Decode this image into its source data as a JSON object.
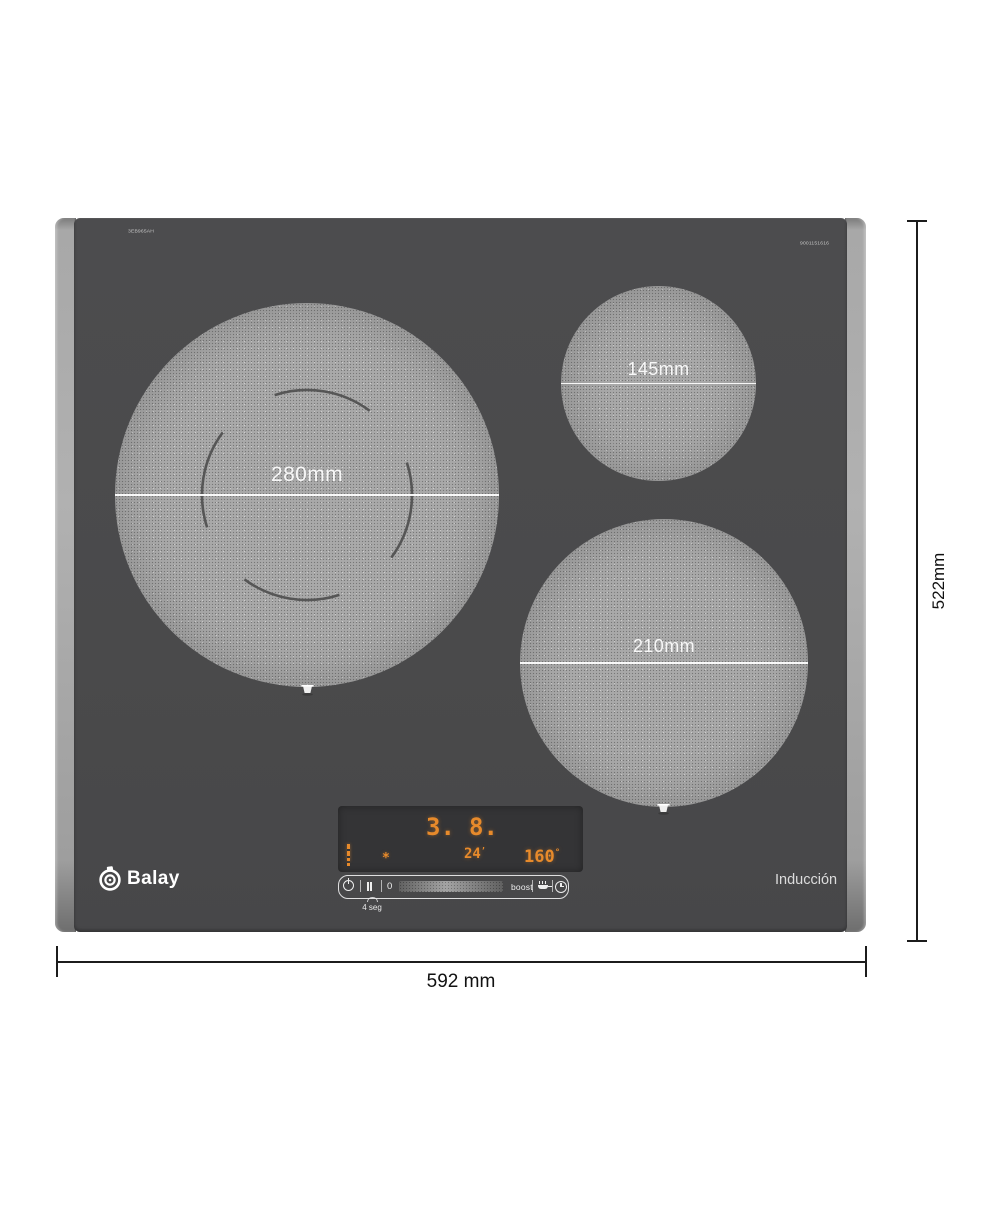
{
  "brand": {
    "name": "Balay"
  },
  "hob": {
    "model_code": "3EB965AH",
    "part_code": "9001151616",
    "tech_label": "Inducción"
  },
  "zones": {
    "large": {
      "diameter_label": "280mm"
    },
    "small": {
      "diameter_label": "145mm"
    },
    "medium": {
      "diameter_label": "210mm"
    }
  },
  "overall": {
    "width_label": "592 mm",
    "height_label": "522mm"
  },
  "display": {
    "left_power": "3.",
    "right_power": "8.",
    "timer": "24",
    "timer_mark": "’",
    "temperature": "160",
    "temp_mark": "°",
    "aux_glyph": "*"
  },
  "touchbar": {
    "zero_label": "0",
    "boost_label": "boost",
    "hold_hint": "4 seg"
  },
  "icons": {
    "power": "power-circle",
    "pause": "double-bars",
    "pan": "frying-pan",
    "timer_clock": "clock",
    "logo": "balay-emblem",
    "pan_marker": "pot-position-marker",
    "hold_arc": "press-hold-arc"
  },
  "colors": {
    "glass": "#4a4a4b",
    "trim": "#9f9f9f",
    "zone_fill": "#a9a9a9",
    "digit_orange": "#e78a2b",
    "dimension_line": "#1c1c1c",
    "zone_label": "#f7f7f7"
  }
}
